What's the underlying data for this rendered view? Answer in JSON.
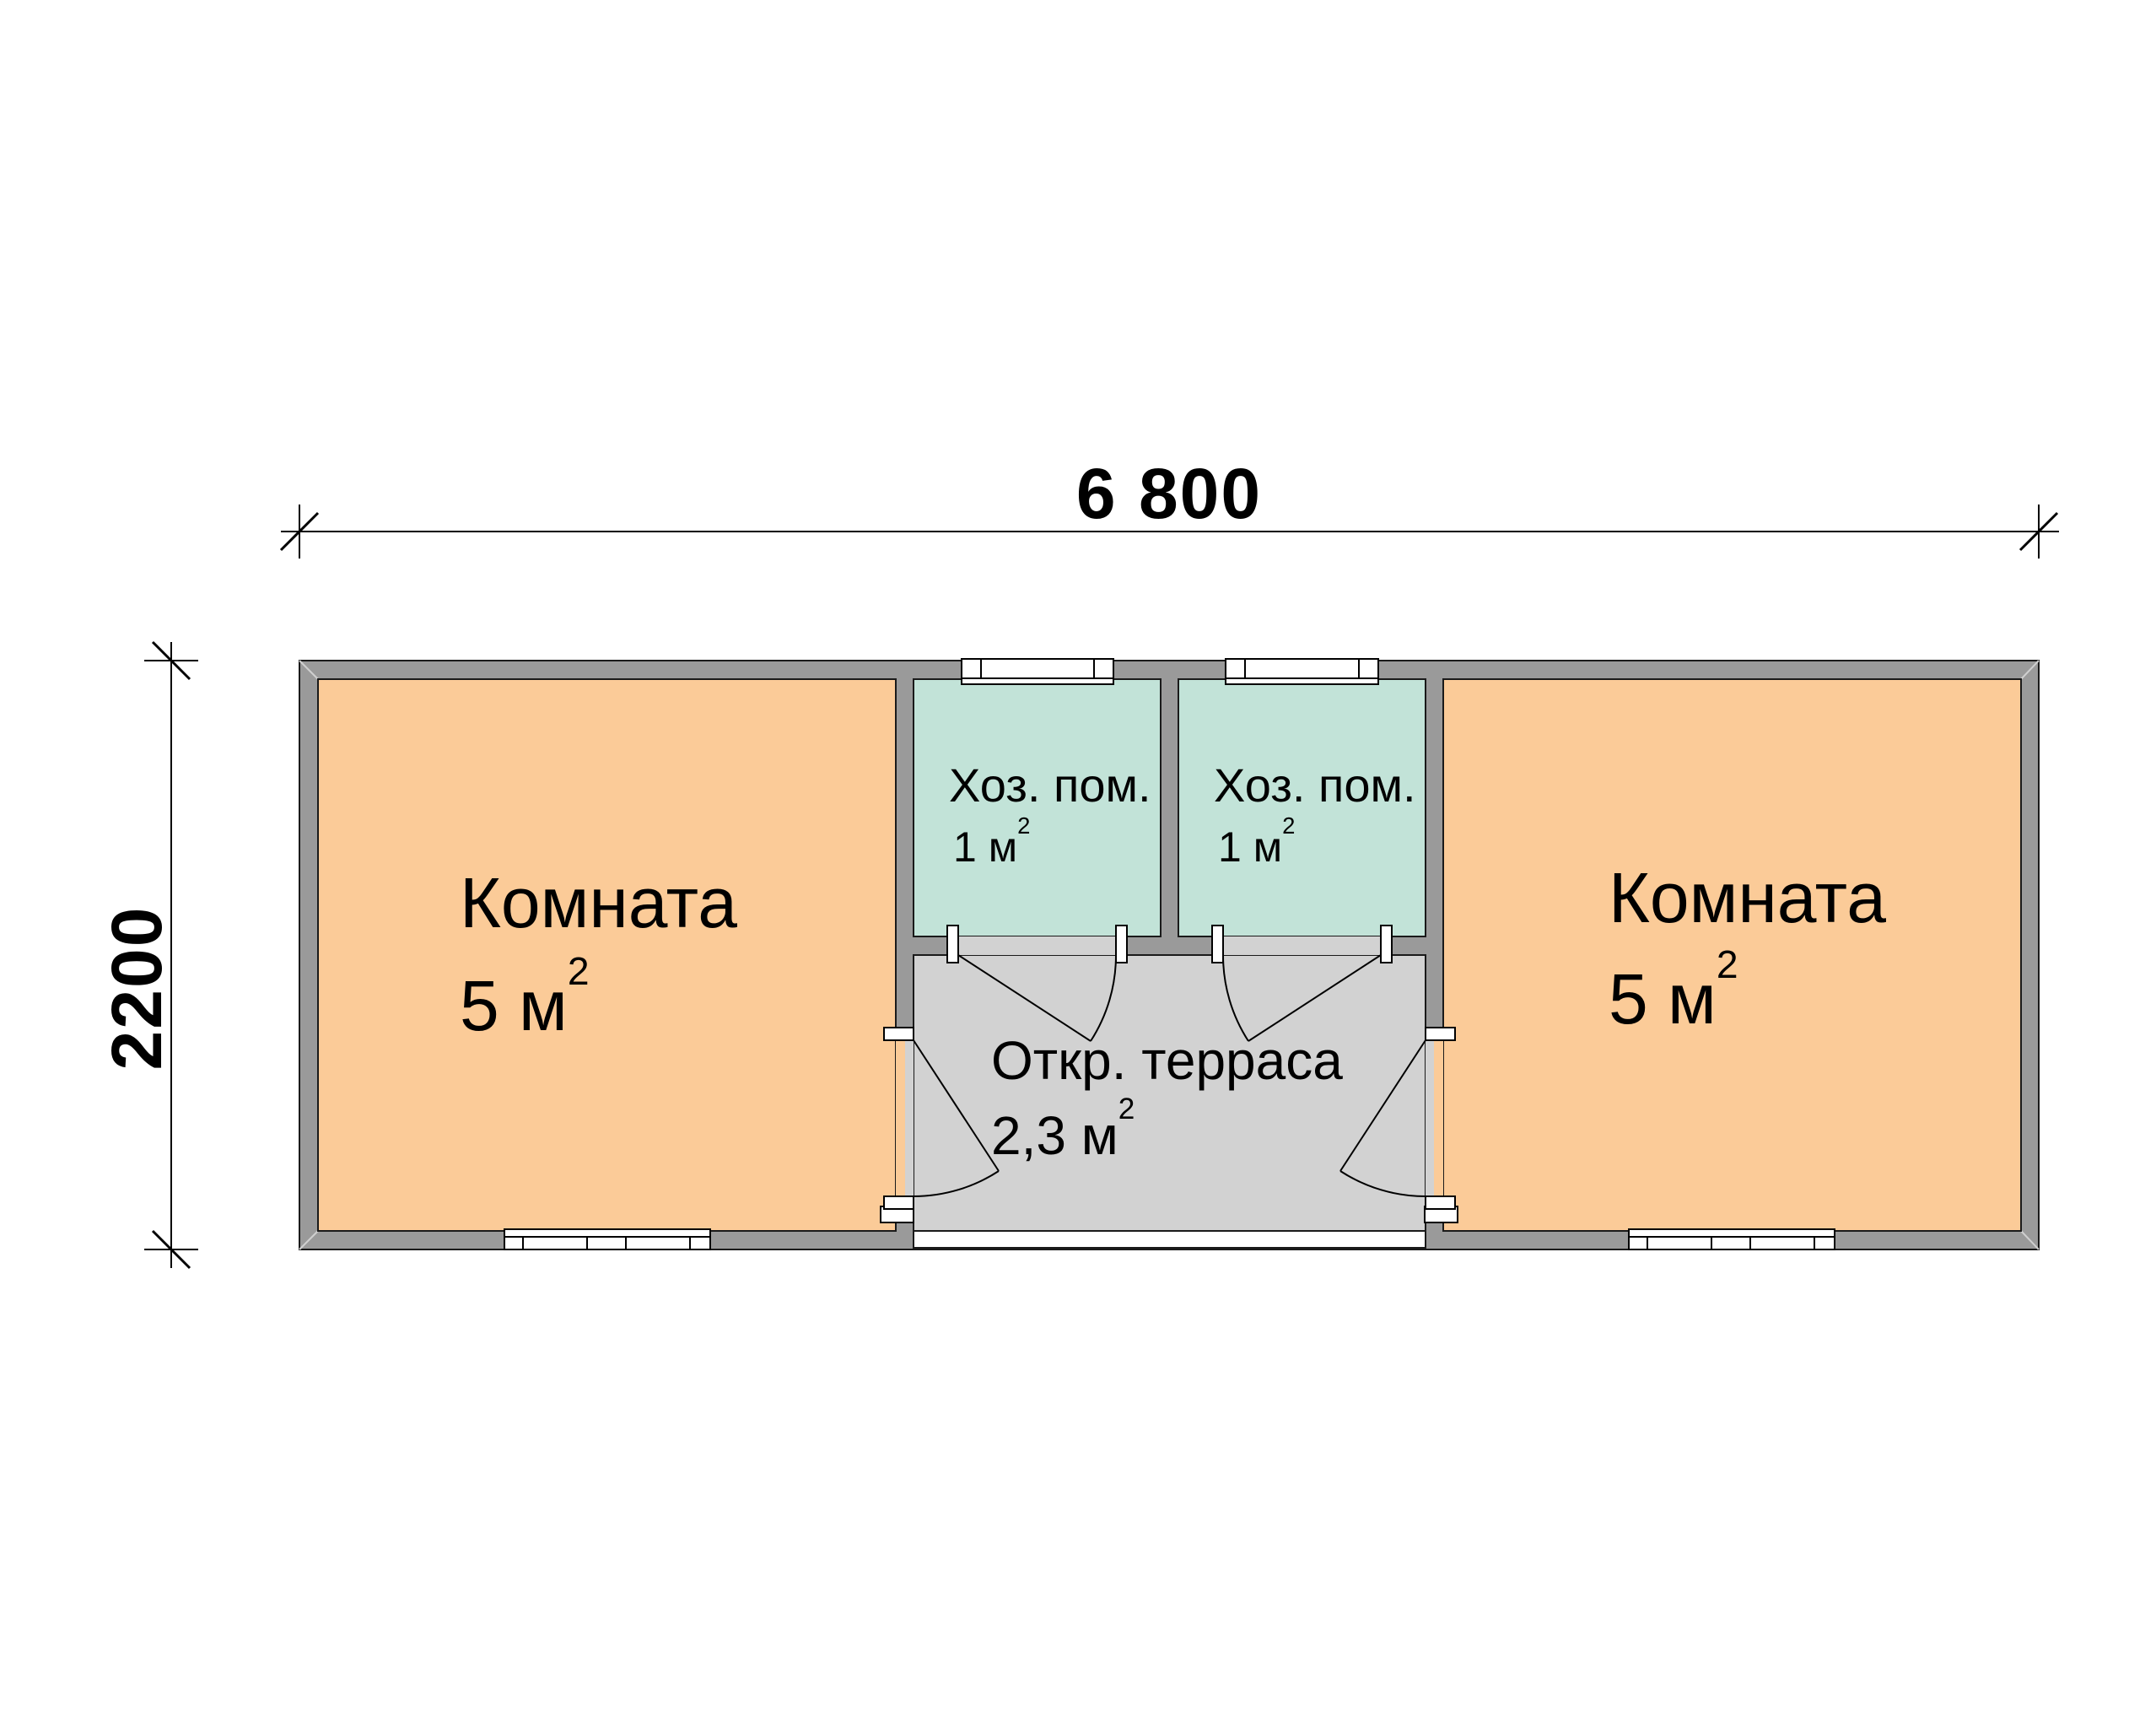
{
  "plan": {
    "dimension_width": "6 800",
    "dimension_height": "2200",
    "rooms": {
      "room_left": {
        "name": "Комната",
        "area": "5 м",
        "area_sup": "2"
      },
      "utility_left": {
        "name": "Хоз. пом.",
        "area": "1 м",
        "area_sup": "2"
      },
      "utility_right": {
        "name": "Хоз. пом.",
        "area": "1 м",
        "area_sup": "2"
      },
      "terrace": {
        "name": "Откр. терраса",
        "area": "2,3 м",
        "area_sup": "2"
      },
      "room_right": {
        "name": "Комната",
        "area": "5 м",
        "area_sup": "2"
      }
    }
  },
  "colors": {
    "room_fill": "#FBCB98",
    "utility_fill": "#C2E3D8",
    "terrace_fill": "#D2D2D2",
    "wall_fill": "#9A9A9A",
    "wall_edge": "#1A1A1A",
    "line": "#000000",
    "background": "#FFFFFF"
  }
}
